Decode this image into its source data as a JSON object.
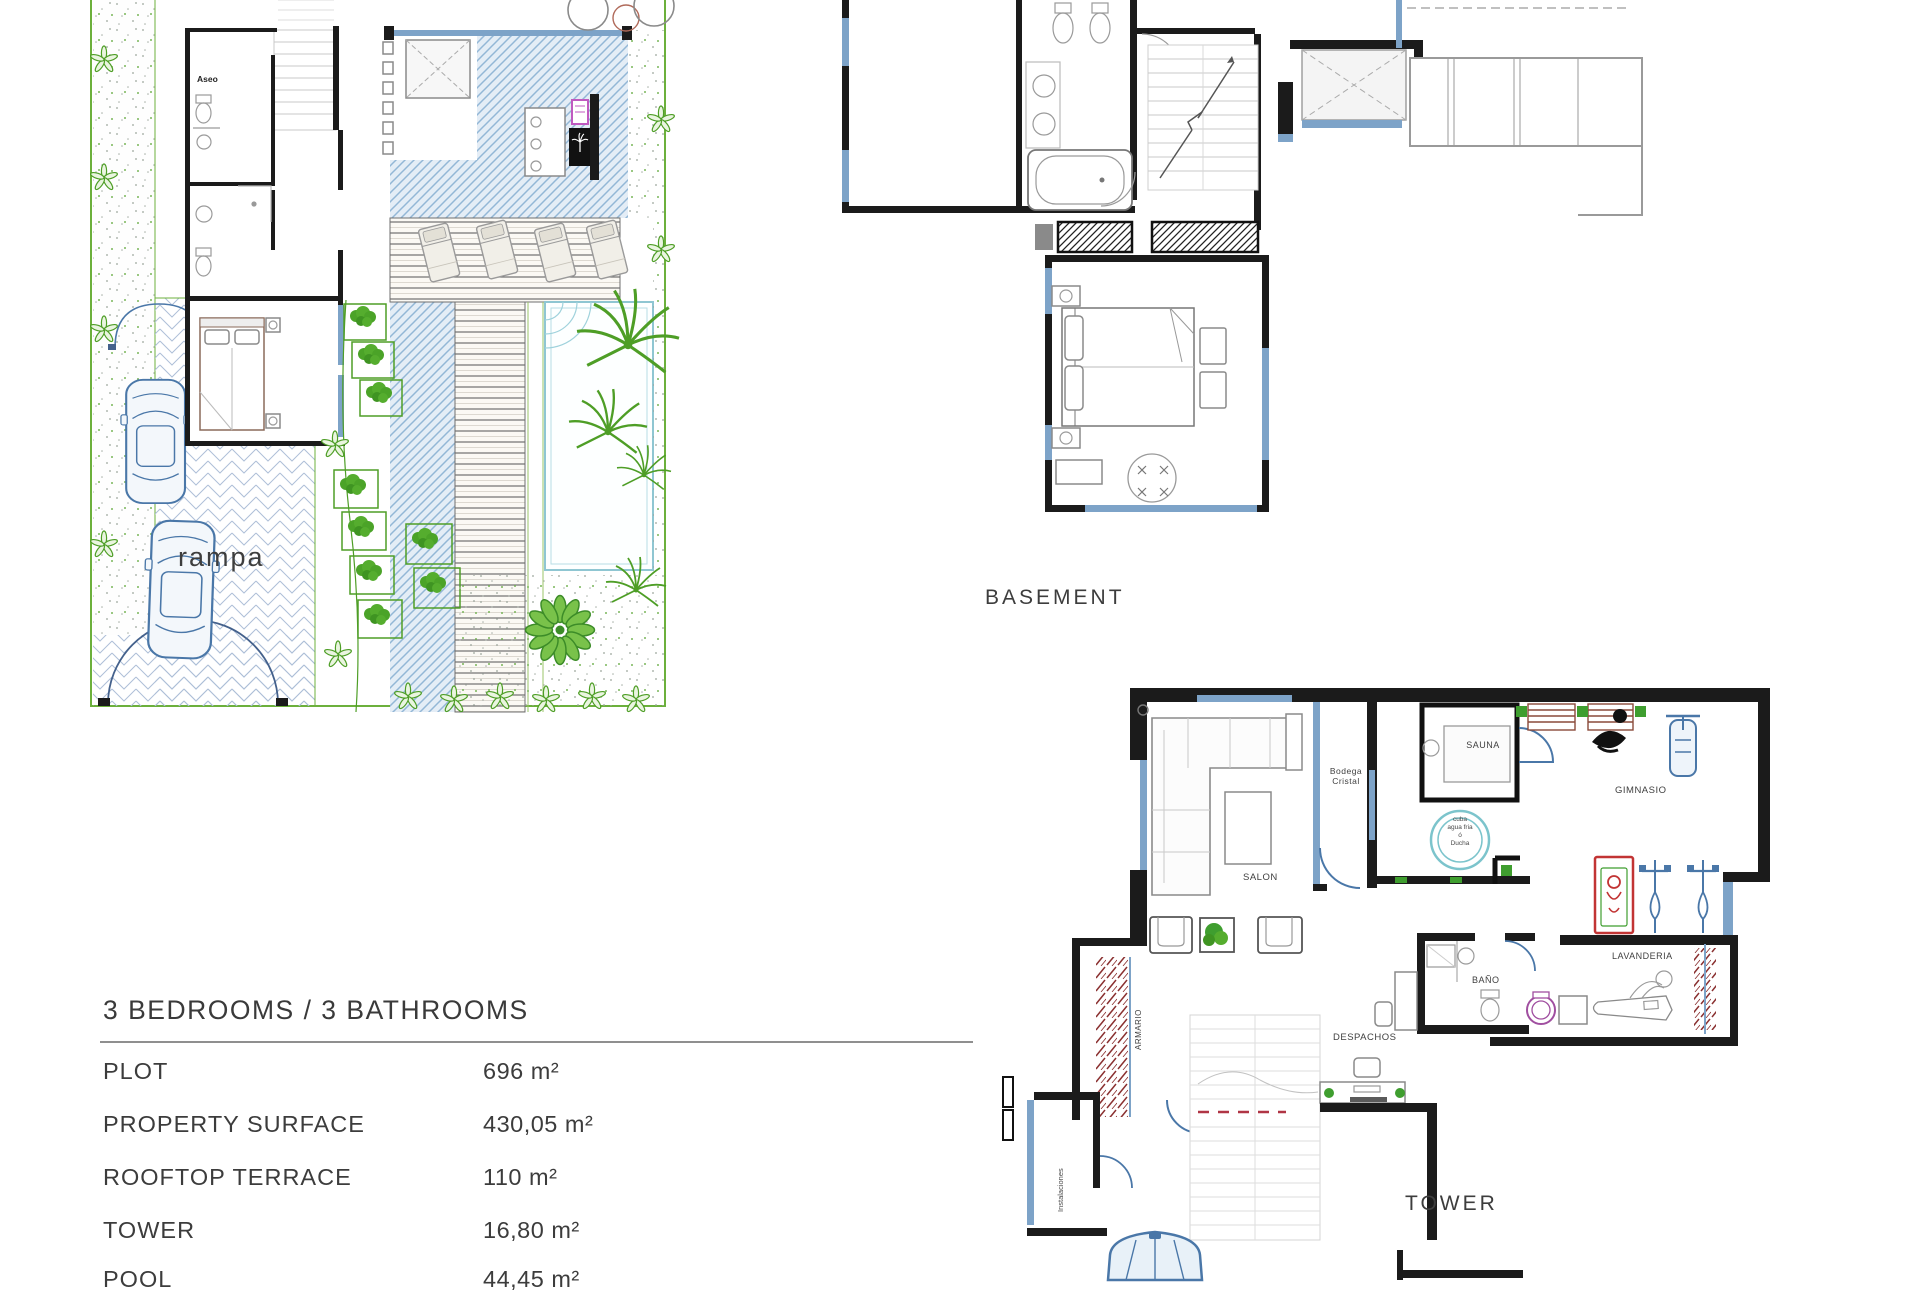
{
  "site_plan": {
    "labels": {
      "aseo": "Aseo",
      "rampa": "rampa"
    }
  },
  "basement_plan": {
    "title": "BASEMENT"
  },
  "tower_plan": {
    "title": "TOWER",
    "rooms": {
      "salon": "SALON",
      "bodega_line1": "Bodega",
      "bodega_line2": "Cristal",
      "sauna": "SAUNA",
      "cuba_line1": "cuba",
      "cuba_line2": "agua fria",
      "cuba_line3": "ó",
      "cuba_line4": "Ducha",
      "gimnasio": "GIMNASIO",
      "bano": "BAÑO",
      "despachos": "DESPACHOS",
      "lavanderia": "LAVANDERIA",
      "armario": "ARMARIO",
      "instalaciones": "Instalaciones"
    }
  },
  "specs": {
    "title": "3 BEDROOMS / 3 BATHROOMS",
    "rows": [
      {
        "label": "PLOT",
        "value": "696 m²"
      },
      {
        "label": "PROPERTY SURFACE",
        "value": "430,05 m²"
      },
      {
        "label": "ROOFTOP TERRACE",
        "value": "110 m²"
      },
      {
        "label": "TOWER",
        "value": "16,80 m²"
      },
      {
        "label": "POOL",
        "value": "44,45 m²"
      }
    ]
  },
  "colors": {
    "plot_green": "#6cb03c",
    "plant_green": "#4e9e26",
    "hatch_blue": "#93b7d6",
    "glass_blue": "#7da3c8",
    "car_blue": "#4a77a8",
    "wall_black": "#1b1b1b",
    "pool_cyan": "#9fd2dc",
    "washer_purple": "#a04fa0",
    "machine_red": "#c23434",
    "bench_brown": "#8a4a3a",
    "text_dark": "#3b3b3b"
  }
}
